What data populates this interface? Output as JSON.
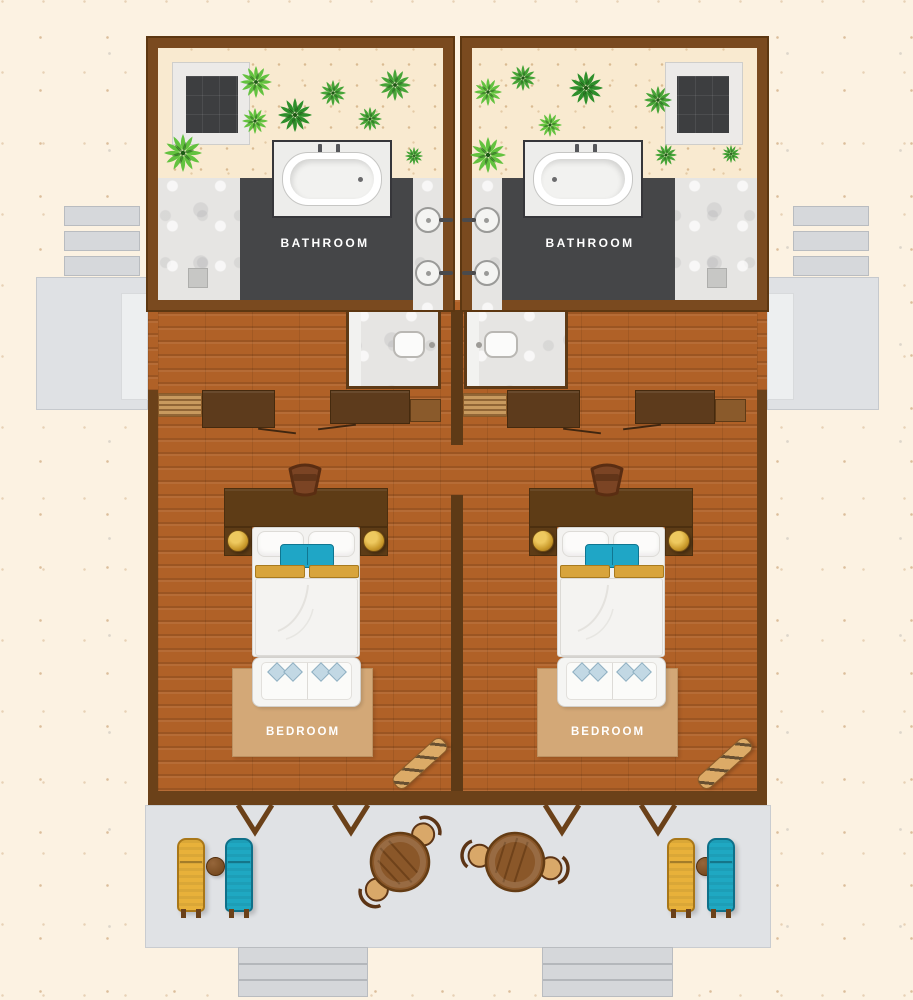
{
  "plan": {
    "type": "twin-room-floor-plan",
    "units": [
      {
        "bathroom_label": "BATHROOM",
        "bedroom_label": "BEDROOM"
      },
      {
        "bathroom_label": "BATHROOM",
        "bedroom_label": "BEDROOM"
      }
    ]
  },
  "colors": {
    "background": "#fcf2e2",
    "wall": "#7a4a1f",
    "wall_dark": "#5e3a16",
    "wood_floor": "#b06127",
    "bathroom_floor": "#454648",
    "sand": "#f9ead0",
    "marble": "#e6e5e3",
    "deck": "#e0e2e5",
    "rug": "#d3a877",
    "lounger_yellow": "#e8b13a",
    "lounger_teal": "#1fa8c2",
    "accent_teal": "#1fa6c6",
    "accent_gold": "#d8a43c",
    "plant_green_1": "#46a437",
    "plant_green_2": "#63c23f",
    "plant_green_3": "#2e8f2b"
  },
  "plants": [
    {
      "x": 256,
      "y": 82,
      "r": 16,
      "tone": "#63c23f"
    },
    {
      "x": 333,
      "y": 93,
      "r": 13,
      "tone": "#46a437"
    },
    {
      "x": 295,
      "y": 115,
      "r": 17,
      "tone": "#2e8f2b"
    },
    {
      "x": 395,
      "y": 85,
      "r": 16,
      "tone": "#46a437"
    },
    {
      "x": 255,
      "y": 121,
      "r": 13,
      "tone": "#63c23f"
    },
    {
      "x": 370,
      "y": 119,
      "r": 12,
      "tone": "#46a437"
    },
    {
      "x": 183,
      "y": 153,
      "r": 19,
      "tone": "#63c23f"
    },
    {
      "x": 414,
      "y": 156,
      "r": 9,
      "tone": "#46a437"
    },
    {
      "x": 488,
      "y": 92,
      "r": 14,
      "tone": "#63c23f"
    },
    {
      "x": 523,
      "y": 78,
      "r": 13,
      "tone": "#46a437"
    },
    {
      "x": 586,
      "y": 88,
      "r": 17,
      "tone": "#2e8f2b"
    },
    {
      "x": 658,
      "y": 100,
      "r": 14,
      "tone": "#46a437"
    },
    {
      "x": 550,
      "y": 125,
      "r": 12,
      "tone": "#63c23f"
    },
    {
      "x": 666,
      "y": 155,
      "r": 11,
      "tone": "#46a437"
    },
    {
      "x": 488,
      "y": 155,
      "r": 18,
      "tone": "#63c23f"
    },
    {
      "x": 731,
      "y": 154,
      "r": 9,
      "tone": "#46a437"
    }
  ],
  "door_swings": [
    {
      "x1": 238,
      "x2": 272,
      "y": 805,
      "apex_y": 832
    },
    {
      "x1": 334,
      "x2": 368,
      "y": 805,
      "apex_y": 832
    },
    {
      "x1": 545,
      "x2": 579,
      "y": 805,
      "apex_y": 832
    },
    {
      "x1": 641,
      "x2": 675,
      "y": 805,
      "apex_y": 832
    }
  ],
  "dining_sets": [
    {
      "x": 400,
      "y": 862,
      "rot": 40
    },
    {
      "x": 515,
      "y": 862,
      "rot": 100
    }
  ],
  "desk_chairs": [
    {
      "x": 305,
      "y": 480
    },
    {
      "x": 607,
      "y": 480
    }
  ],
  "bed_creases": [
    {
      "x": 300,
      "y": 615
    },
    {
      "x": 600,
      "y": 615
    }
  ]
}
